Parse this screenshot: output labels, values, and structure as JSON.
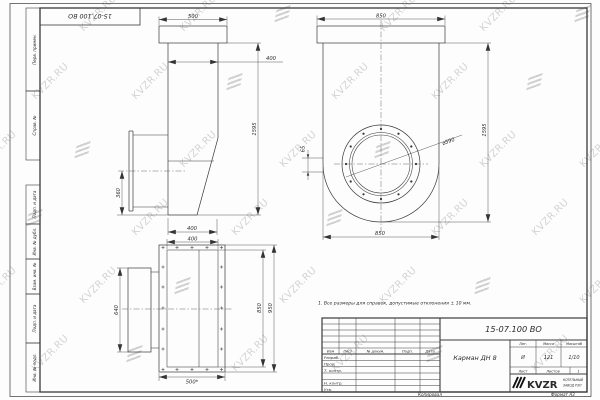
{
  "watermark": {
    "text": "KVZR.RU"
  },
  "sheet": {
    "corner_stamp": "15-07.100 ВО",
    "margin_labels": [
      "Перв. примен.",
      "Справ. №",
      "Подп. и дата",
      "Инв. № дубл.",
      "Взам. инв. №",
      "Подп. и дата",
      "Инв. № подл."
    ],
    "note": "1. Все размеры для справок, допустимые отклонения ± 10 мм.",
    "footer": {
      "copied": "Копировал",
      "format": "Формат А3"
    }
  },
  "drawing": {
    "side_view": {
      "dim_flange_width": "500",
      "dim_body_width": "400",
      "dim_height": "1595",
      "dim_outlet_height": "360",
      "dim_bottom_width": "400"
    },
    "front_view": {
      "dim_flange_width": "850",
      "dim_offset": "65",
      "dim_diameter": "⌀590",
      "dim_height": "1595",
      "dim_bottom_width": "850"
    },
    "flange_view": {
      "dim_top_width": "400",
      "dim_left_height": "640",
      "dim_inner_height": "850",
      "dim_outer_height": "950",
      "dim_bottom_width": "500*"
    }
  },
  "title_block": {
    "doc_number": "15-07.100 ВО",
    "part_name": "Карман ДН 8",
    "header_cols": [
      "Изм",
      "Лист",
      "№ докум.",
      "Подп.",
      "Дата"
    ],
    "row_labels": [
      "Разраб.",
      "Пров.",
      "Т. контр.",
      "Н. контр.",
      "Утв."
    ],
    "lit_header": [
      "Лит.",
      "Масса",
      "Масштаб"
    ],
    "lit_values": [
      "И",
      "121",
      "1/10"
    ],
    "sheet_row": {
      "sheet_label": "Лист",
      "sheets_label": "Листов",
      "sheets_value": "1"
    },
    "company": {
      "logo_text": "KVZR",
      "name_line1": "КОТЕЛЬНЫЙ",
      "name_line2": "ЗАВОД РЭП"
    }
  }
}
